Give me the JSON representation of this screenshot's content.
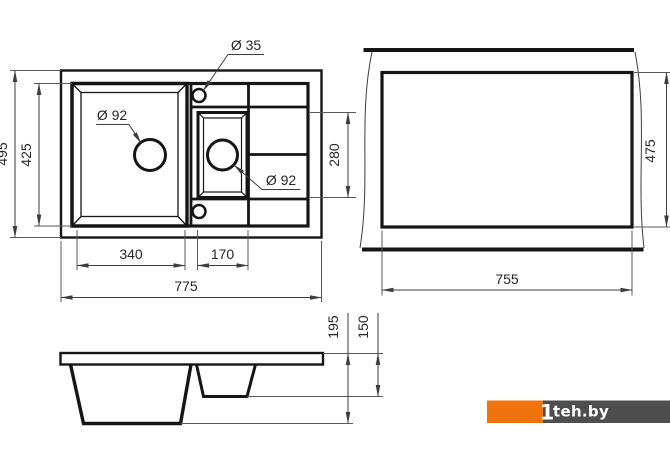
{
  "views": {
    "top_view": {
      "title": "sink top view",
      "dim_total_width": "775",
      "dim_main_bowl_width": "340",
      "dim_small_bowl_width": "170",
      "dim_total_depth": "495",
      "dim_bowl_depth": "425",
      "dim_small_bowl_length": "280",
      "label_faucet_hole_diameter": "Ø 35",
      "label_main_drain_diameter": "Ø 92",
      "label_small_drain_diameter": "Ø 92"
    },
    "cutout_view": {
      "title": "countertop cutout view",
      "dim_cutout_width": "755",
      "dim_cutout_depth": "475"
    },
    "side_view": {
      "title": "sink side profile view",
      "dim_main_bowl_depth": "195",
      "dim_small_bowl_depth": "150"
    }
  },
  "watermark": {
    "mark": "1",
    "site": "teh.by",
    "orange": "#F1730D",
    "dark": "#4E4E4E"
  },
  "colors": {
    "line": "#151515",
    "dim": "#3d3d3d",
    "background": "#ffffff"
  }
}
